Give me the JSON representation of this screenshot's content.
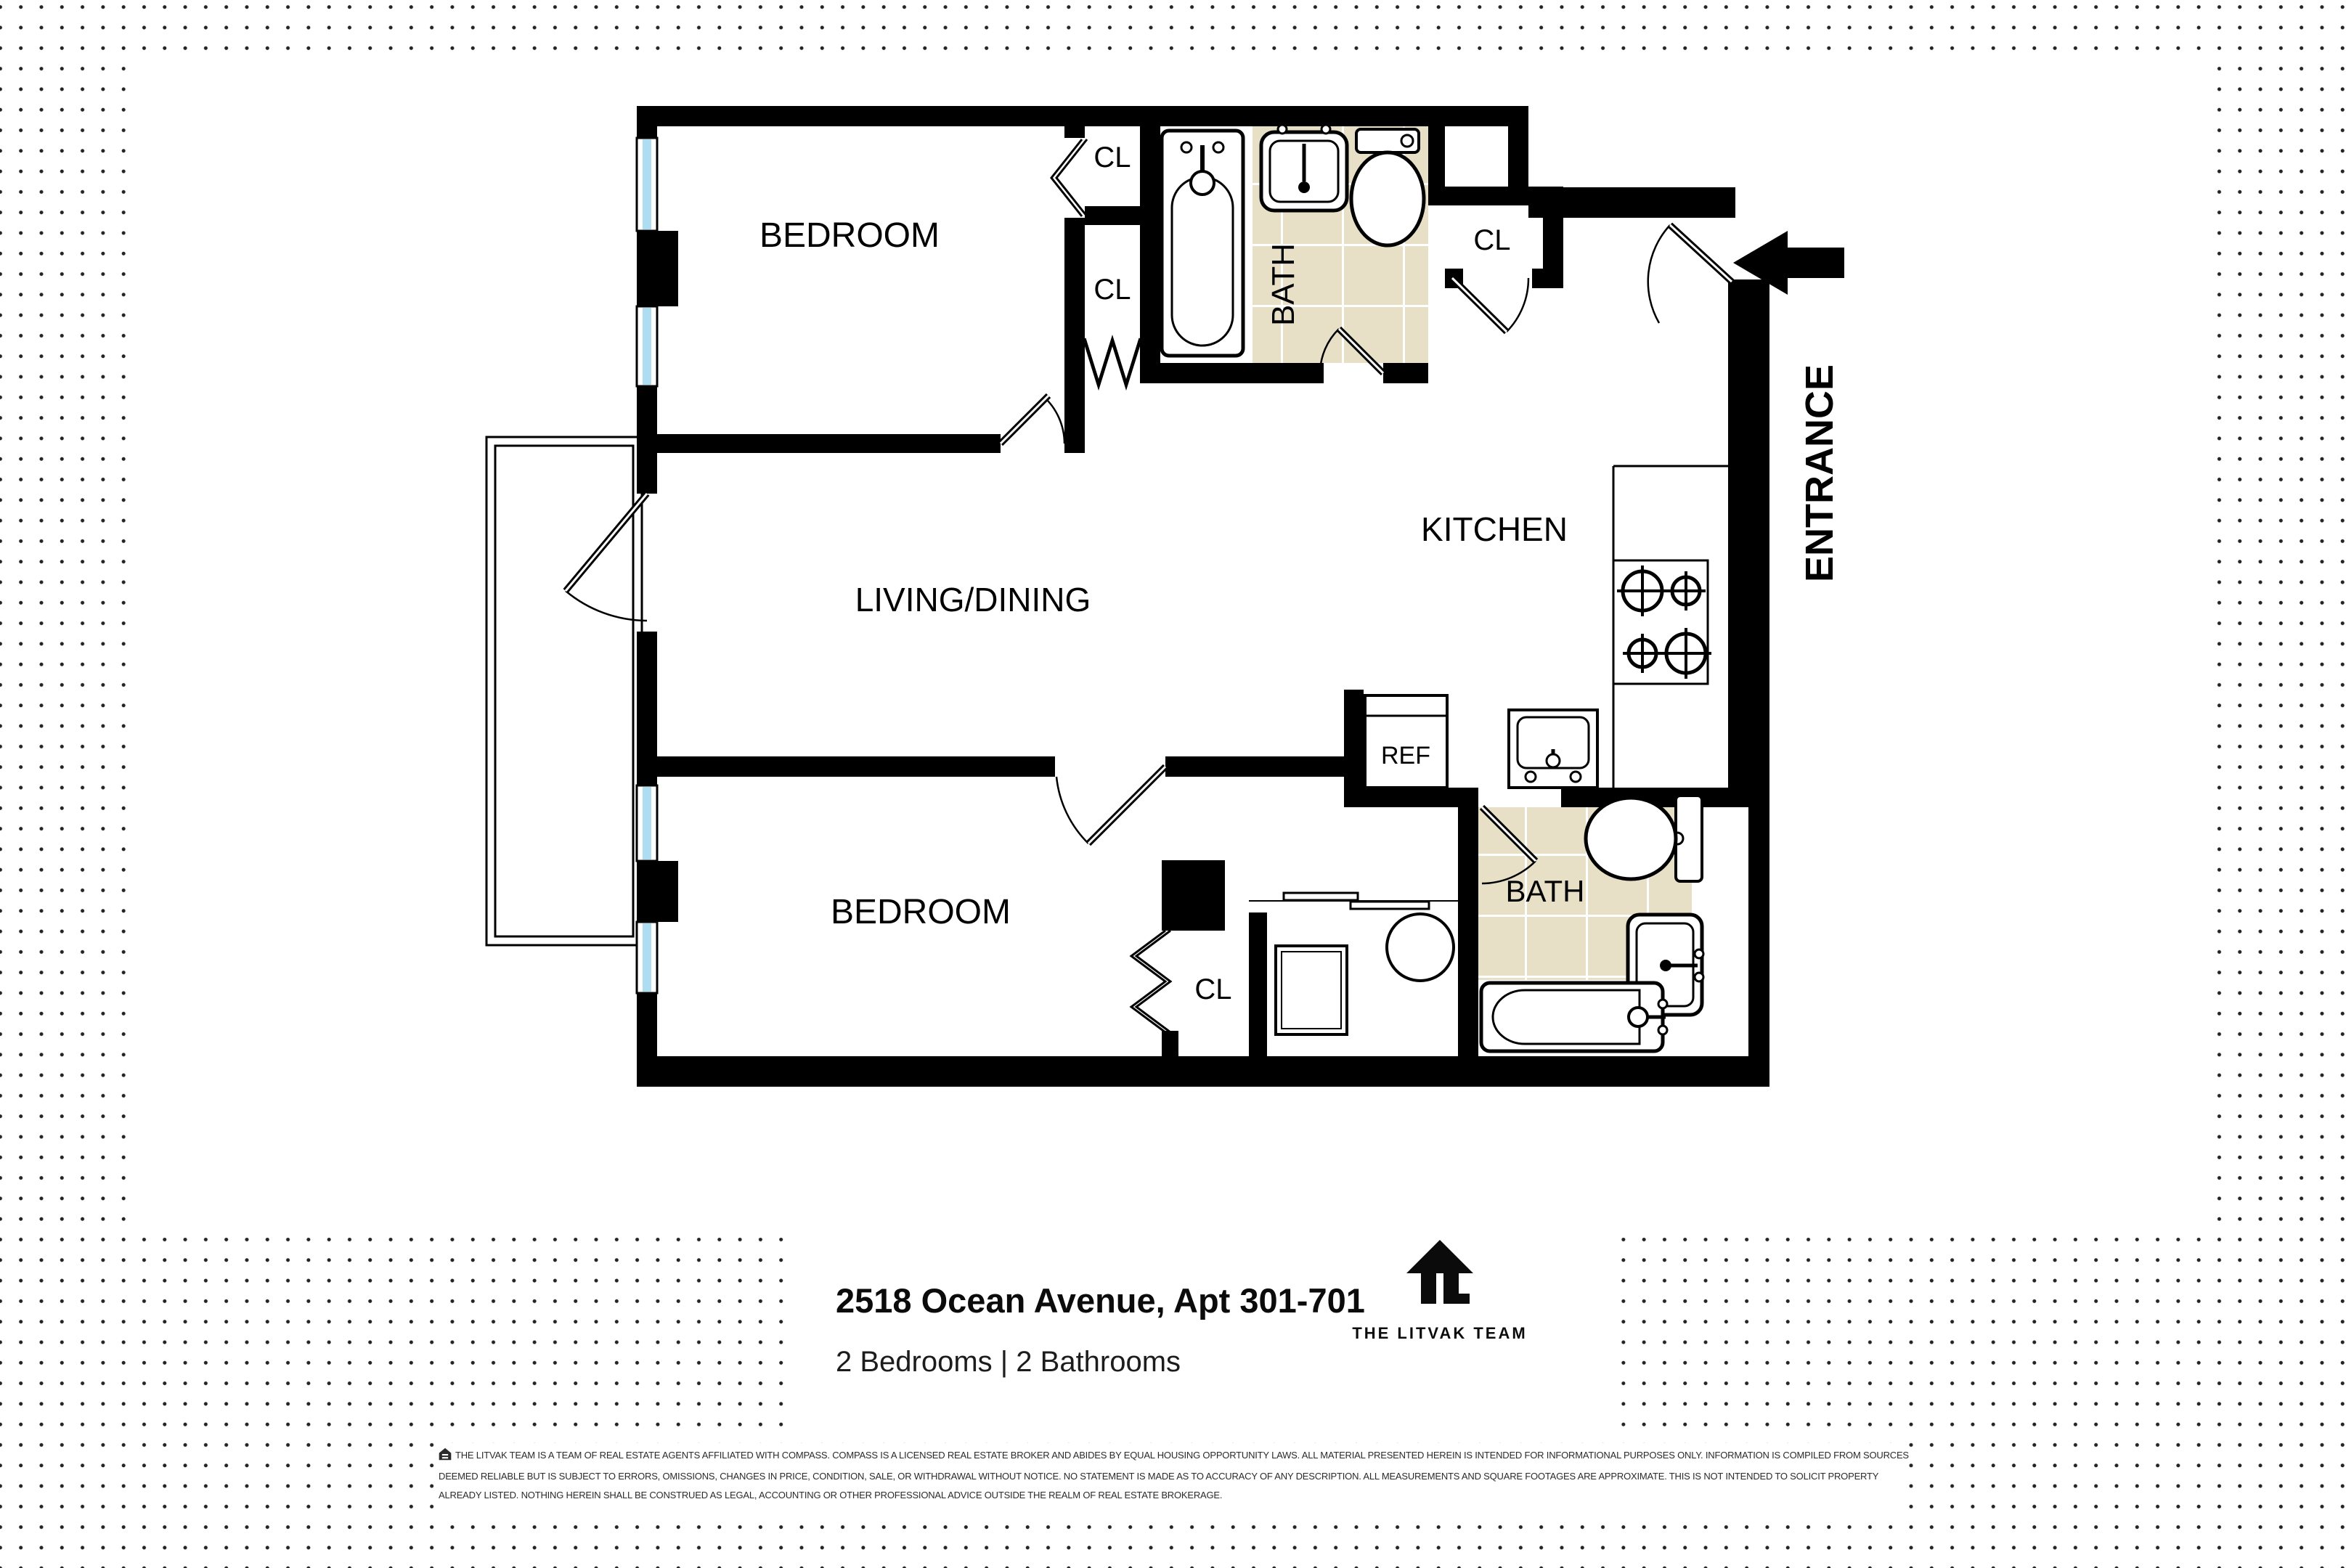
{
  "plan": {
    "rooms": {
      "bedroom_upper": "BEDROOM",
      "bedroom_lower": "BEDROOM",
      "living_dining": "LIVING/DINING",
      "kitchen": "KITCHEN",
      "bath_upper": "BATH",
      "bath_lower": "BATH",
      "closet": "CL",
      "fridge": "REF",
      "entrance": "ENTRANCE"
    },
    "colors": {
      "wall": "#000000",
      "window_glass": "#aedcf0",
      "window_frame": "#e9f6fc",
      "tile": "#e7dfc6",
      "tile_grout": "#ffffff",
      "dot": "#232323"
    }
  },
  "footer": {
    "address": "2518 Ocean Avenue, Apt 301-701",
    "summary": "2 Bedrooms | 2 Bathrooms",
    "brand": "THE LITVAK TEAM"
  },
  "disclaimer": {
    "lines": [
      "THE LITVAK TEAM IS A TEAM OF REAL ESTATE AGENTS AFFILIATED WITH COMPASS. COMPASS IS A LICENSED REAL ESTATE BROKER AND ABIDES BY EQUAL HOUSING OPPORTUNITY LAWS. ALL MATERIAL PRESENTED HEREIN IS INTENDED FOR INFORMATIONAL PURPOSES ONLY. INFORMATION IS COMPILED FROM SOURCES",
      "DEEMED RELIABLE BUT IS SUBJECT TO ERRORS, OMISSIONS, CHANGES IN PRICE, CONDITION, SALE, OR WITHDRAWAL WITHOUT NOTICE. NO STATEMENT IS MADE AS TO ACCURACY OF ANY DESCRIPTION. ALL MEASUREMENTS AND SQUARE FOOTAGES ARE APPROXIMATE. THIS IS NOT INTENDED TO SOLICIT PROPERTY",
      "ALREADY LISTED. NOTHING HEREIN SHALL BE CONSTRUED AS LEGAL, ACCOUNTING OR OTHER PROFESSIONAL ADVICE OUTSIDE THE REALM OF REAL ESTATE BROKERAGE."
    ]
  }
}
